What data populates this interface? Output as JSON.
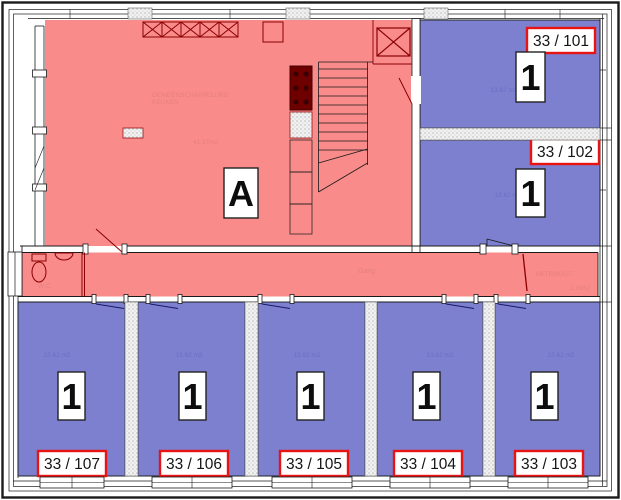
{
  "plan": {
    "common_area": {
      "label": "A",
      "name_line1": "GEMEENSCHAPPELIJKE",
      "name_line2": "KEUKEN",
      "area": "41.37m2"
    },
    "corridor_label": "Gang",
    "meterkast": {
      "label": "METERKAST",
      "area": "2.19m2"
    },
    "wc_label": "W.C.",
    "units": [
      {
        "number": "33 / 101",
        "type": "1",
        "area": "13.62 m2"
      },
      {
        "number": "33 / 102",
        "type": "1",
        "area": "13.62 m2"
      },
      {
        "number": "33 / 103",
        "type": "1",
        "area": "13.62 m2"
      },
      {
        "number": "33 / 104",
        "type": "1",
        "area": "13.62 m2"
      },
      {
        "number": "33 / 105",
        "type": "1",
        "area": "13.62 m2"
      },
      {
        "number": "33 / 106",
        "type": "1",
        "area": "13.62 m2"
      },
      {
        "number": "33 / 107",
        "type": "1",
        "area": "13.62 m2"
      }
    ],
    "colors": {
      "common_fill": "#F98B8B",
      "unit_fill": "#7C80CF",
      "tag_border": "#E81414",
      "fixture": "#8B0000",
      "wall": "#000000"
    }
  }
}
